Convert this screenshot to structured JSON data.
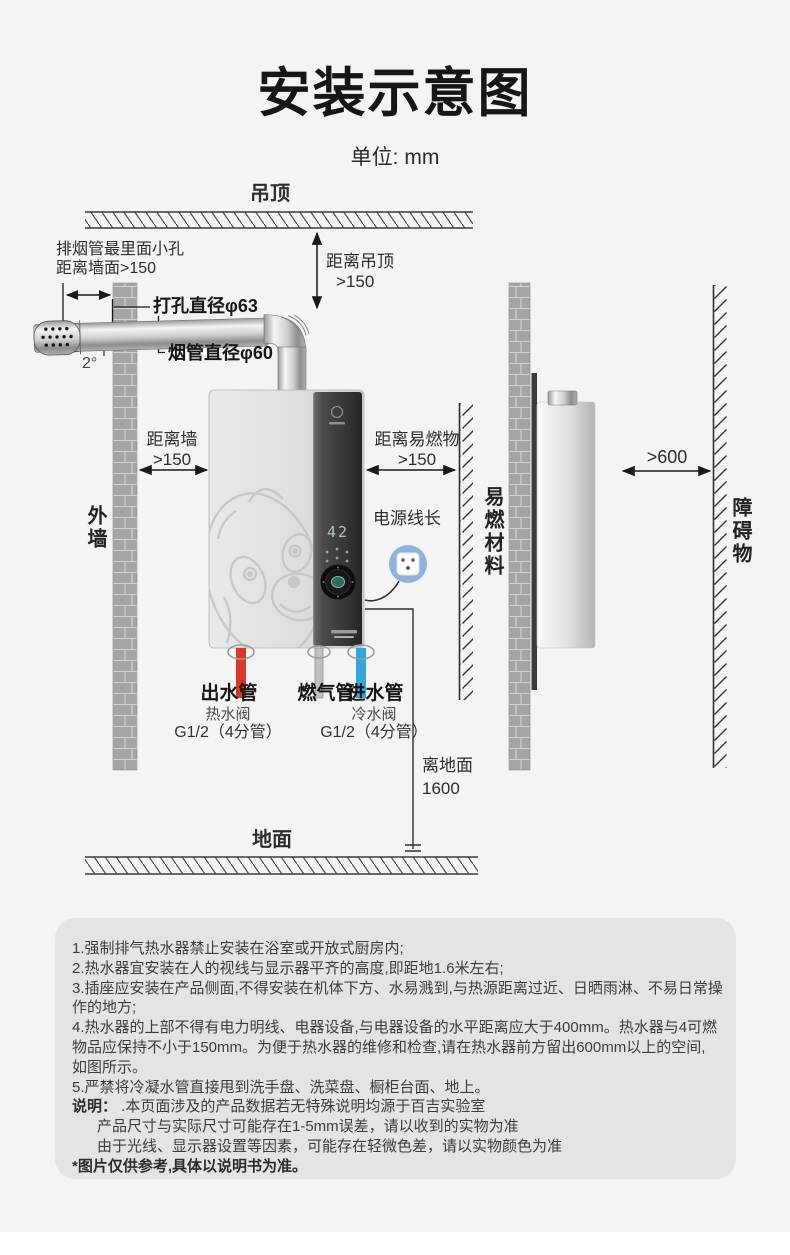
{
  "title": "安装示意图",
  "unit": "单位: mm",
  "labels": {
    "ceiling": "吊顶",
    "ground": "地面",
    "outer_wall": "外墙",
    "flammable_material": "易燃材料",
    "obstacle": "障碍物",
    "dist_ceiling_1": "距离吊顶",
    "dist_ceiling_2": ">150",
    "flue_hole_note_1": "排烟管最里面小孔",
    "flue_hole_note_2": "距离墙面>150",
    "drill_diameter": "打孔直径φ63",
    "flue_diameter": "烟管直径φ60",
    "tilt_angle": "2°",
    "dist_wall_1": "距离墙",
    "dist_wall_2": ">150",
    "dist_flammable_1": "距离易燃物",
    "dist_flammable_2": ">150",
    "dist_obstacle": ">600",
    "power_cord": "电源线长",
    "outlet_pipe": "出水管",
    "gas_pipe": "燃气管",
    "inlet_pipe": "进水管",
    "hot_valve": "热水阀",
    "hot_valve_spec": "G1/2（4分管）",
    "cold_valve": "冷水阀",
    "cold_valve_spec": "G1/2（4分管）",
    "above_ground_1": "离地面",
    "above_ground_2": "1600"
  },
  "heater": {
    "display_value": "42"
  },
  "notes": {
    "lines": [
      {
        "text": "1.强制排气热水器禁止安装在浴室或开放式厨房内;"
      },
      {
        "text": "2.热水器宜安装在人的视线与显示器平齐的高度,即距地1.6米左右;"
      },
      {
        "text": "3.插座应安装在产品侧面,不得安装在机体下方、水易溅到,与热源距离过近、日晒雨淋、不易日常操"
      },
      {
        "text": "作的地方;"
      },
      {
        "text": "4.热水器的上部不得有电力明线、电器设备,与电器设备的水平距离应大于400mm。热水器与4可燃"
      },
      {
        "text": "物品应保持不小于150mm。为便于热水器的维修和检查,请在热水器前方留出600mm以上的空间,"
      },
      {
        "text": "如图所示。"
      },
      {
        "text": "5.严禁将冷凝水管直接甩到洗手盘、洗菜盘、橱柜台面、地上。"
      },
      {
        "prefix": "说明：",
        "text": " .本页面涉及的产品数据若无特殊说明均源于百吉实验室"
      },
      {
        "text": "产品尺寸与实际尺寸可能存在1-5mm误差，请以收到的实物为准"
      },
      {
        "text": "由于光线、显示器设置等因素，可能存在轻微色差，请以实物颜色为准"
      },
      {
        "text": "*图片仅供参考,具体以说明书为准。"
      }
    ]
  },
  "colors": {
    "hot_pipe": "#d9372a",
    "cold_pipe": "#2fa7dd",
    "gas_pipe": "#c0c0c0",
    "socket_accent": "#8fb3d6",
    "display_digits": "#a7c6c0",
    "notes_bg": "#e4e4e4"
  }
}
